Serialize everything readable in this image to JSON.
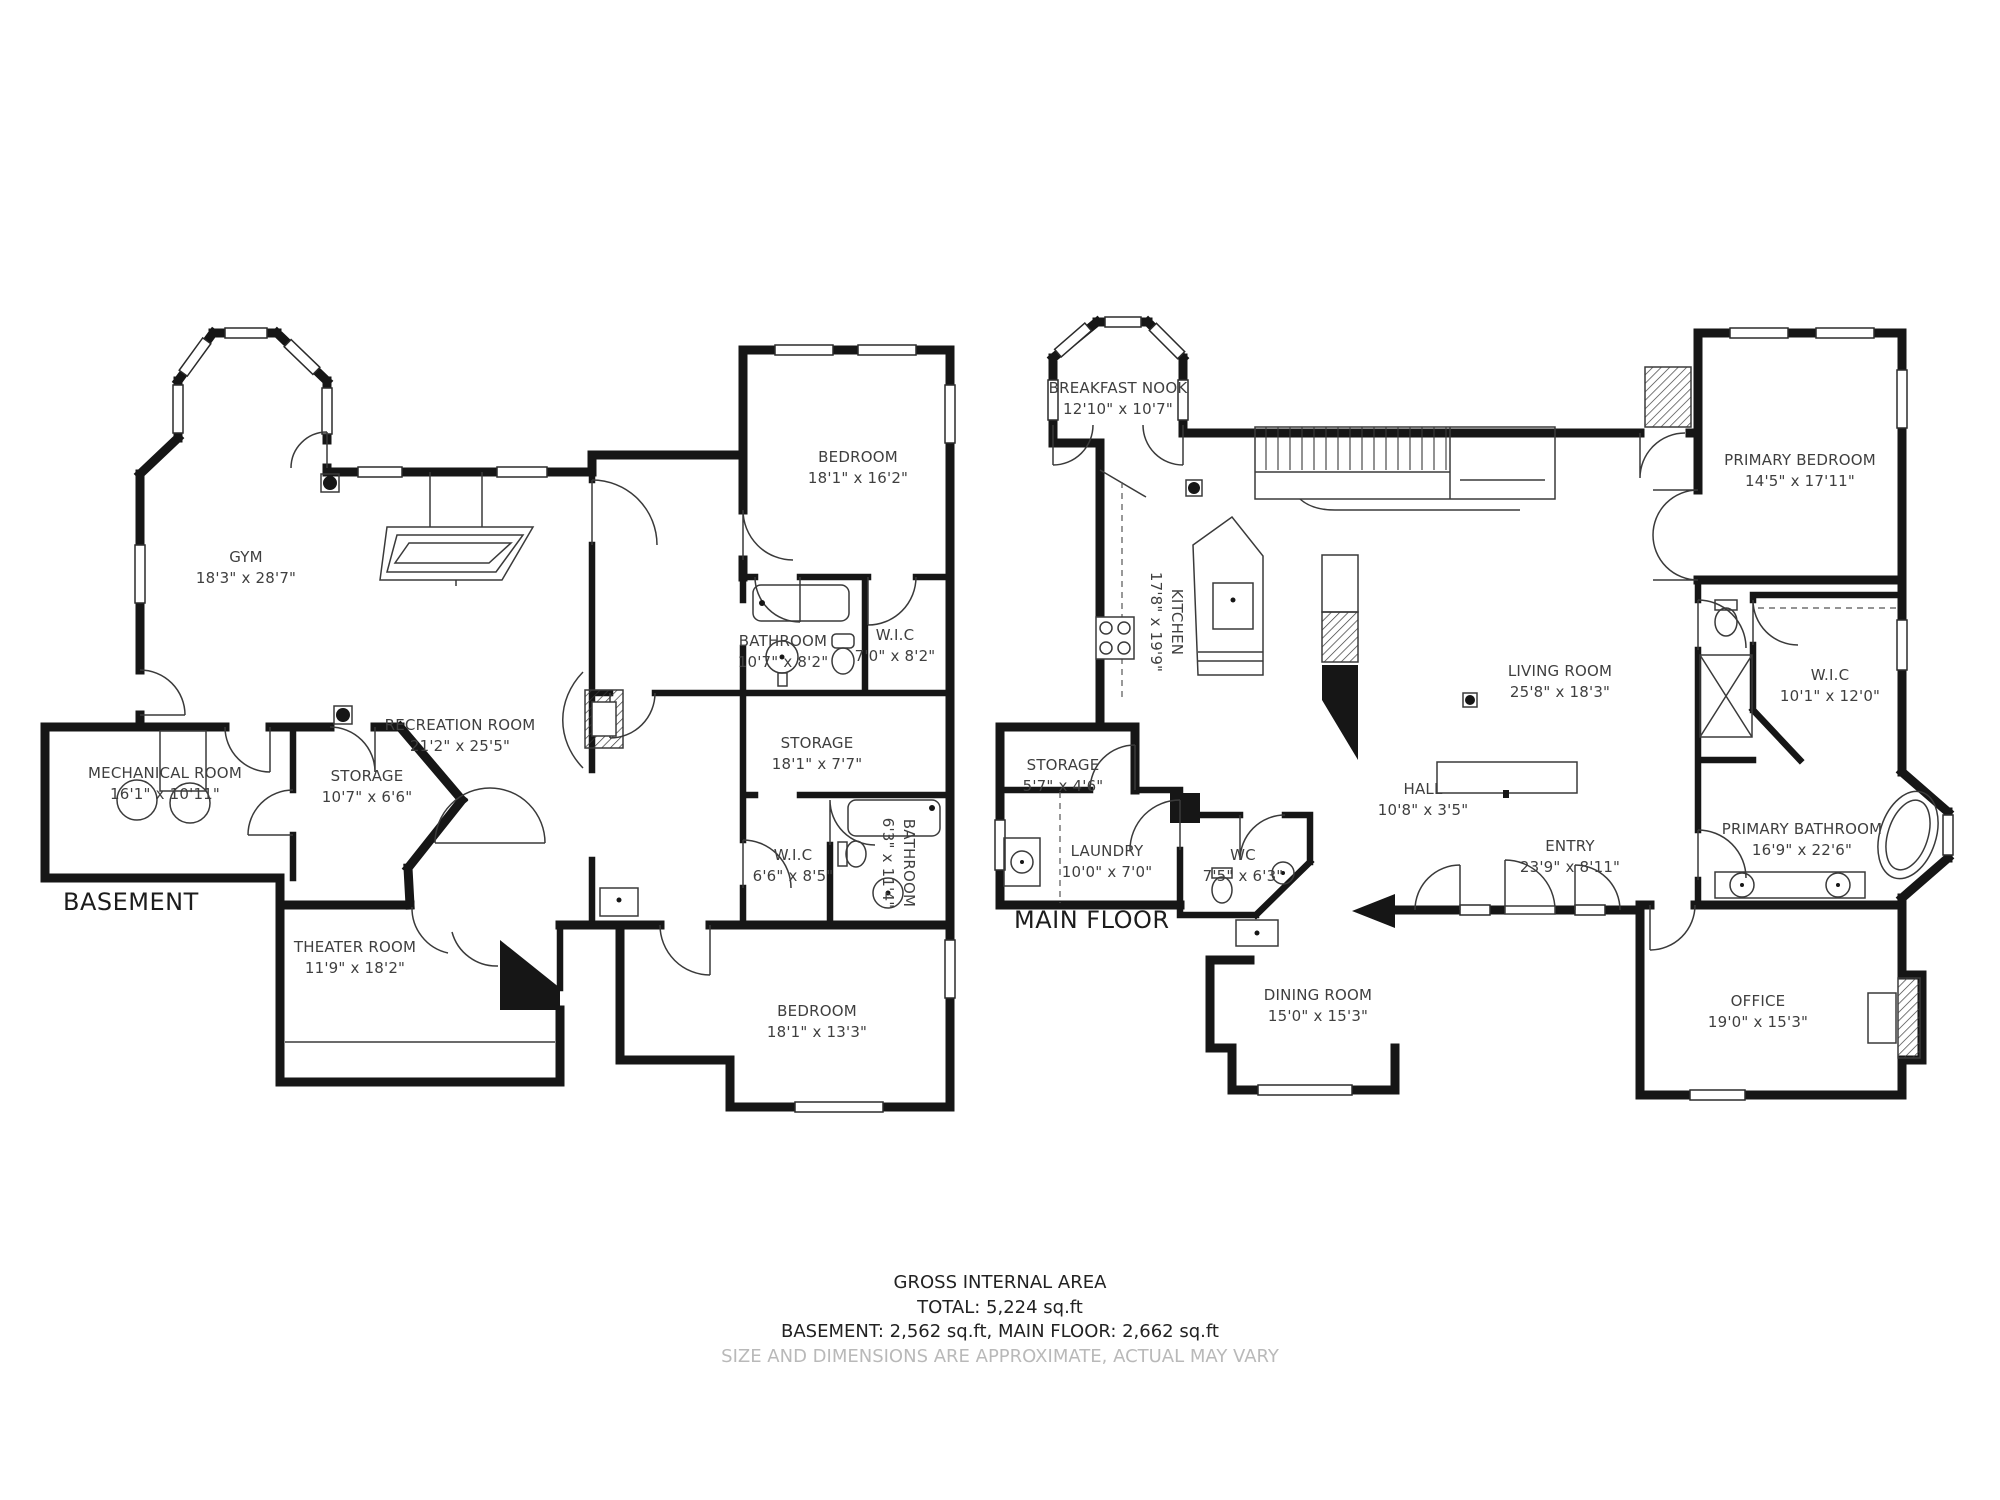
{
  "colors": {
    "wall": "#161616",
    "label": "#3f3f3f",
    "muted_text": "#b9b9b9",
    "background": "#ffffff"
  },
  "floors": [
    {
      "id": "basement",
      "title": "BASEMENT",
      "rooms": [
        {
          "name": "GYM",
          "dims": "18'3\" x 28'7\""
        },
        {
          "name": "BEDROOM",
          "dims": "18'1\" x 16'2\""
        },
        {
          "name": "BATHROOM",
          "dims": "10'7\" x 8'2\""
        },
        {
          "name": "W.I.C",
          "dims": "7'0\" x 8'2\""
        },
        {
          "name": "RECREATION ROOM",
          "dims": "21'2\" x 25'5\""
        },
        {
          "name": "STORAGE",
          "dims": "18'1\" x 7'7\""
        },
        {
          "name": "MECHANICAL ROOM",
          "dims": "16'1\" x 10'11\""
        },
        {
          "name": "STORAGE",
          "dims": "10'7\" x 6'6\""
        },
        {
          "name": "W.I.C",
          "dims": "6'6\" x 8'5\""
        },
        {
          "name": "BATHROOM",
          "dims": "6'3\" x 11'4\""
        },
        {
          "name": "THEATER ROOM",
          "dims": "11'9\" x 18'2\""
        },
        {
          "name": "BEDROOM",
          "dims": "18'1\" x 13'3\""
        }
      ]
    },
    {
      "id": "main-floor",
      "title": "MAIN FLOOR",
      "rooms": [
        {
          "name": "BREAKFAST NOOK",
          "dims": "12'10\" x 10'7\""
        },
        {
          "name": "KITCHEN",
          "dims": "17'8\" x 19'9\""
        },
        {
          "name": "PRIMARY BEDROOM",
          "dims": "14'5\" x 17'11\""
        },
        {
          "name": "LIVING ROOM",
          "dims": "25'8\" x 18'3\""
        },
        {
          "name": "W.I.C",
          "dims": "10'1\" x 12'0\""
        },
        {
          "name": "STORAGE",
          "dims": "5'7\" x 4'6\""
        },
        {
          "name": "LAUNDRY",
          "dims": "10'0\" x 7'0\""
        },
        {
          "name": "HALL",
          "dims": "10'8\" x 3'5\""
        },
        {
          "name": "WC",
          "dims": "7'5\" x 6'3\""
        },
        {
          "name": "ENTRY",
          "dims": "23'9\" x 8'11\""
        },
        {
          "name": "PRIMARY BATHROOM",
          "dims": "16'9\" x 22'6\""
        },
        {
          "name": "DINING ROOM",
          "dims": "15'0\" x 15'3\""
        },
        {
          "name": "OFFICE",
          "dims": "19'0\" x 15'3\""
        }
      ]
    }
  ],
  "footer": {
    "line1": "GROSS INTERNAL AREA",
    "line2": "TOTAL: 5,224 sq.ft",
    "line3": "BASEMENT: 2,562 sq.ft, MAIN FLOOR: 2,662 sq.ft",
    "line4": "SIZE AND DIMENSIONS ARE APPROXIMATE, ACTUAL MAY VARY"
  }
}
